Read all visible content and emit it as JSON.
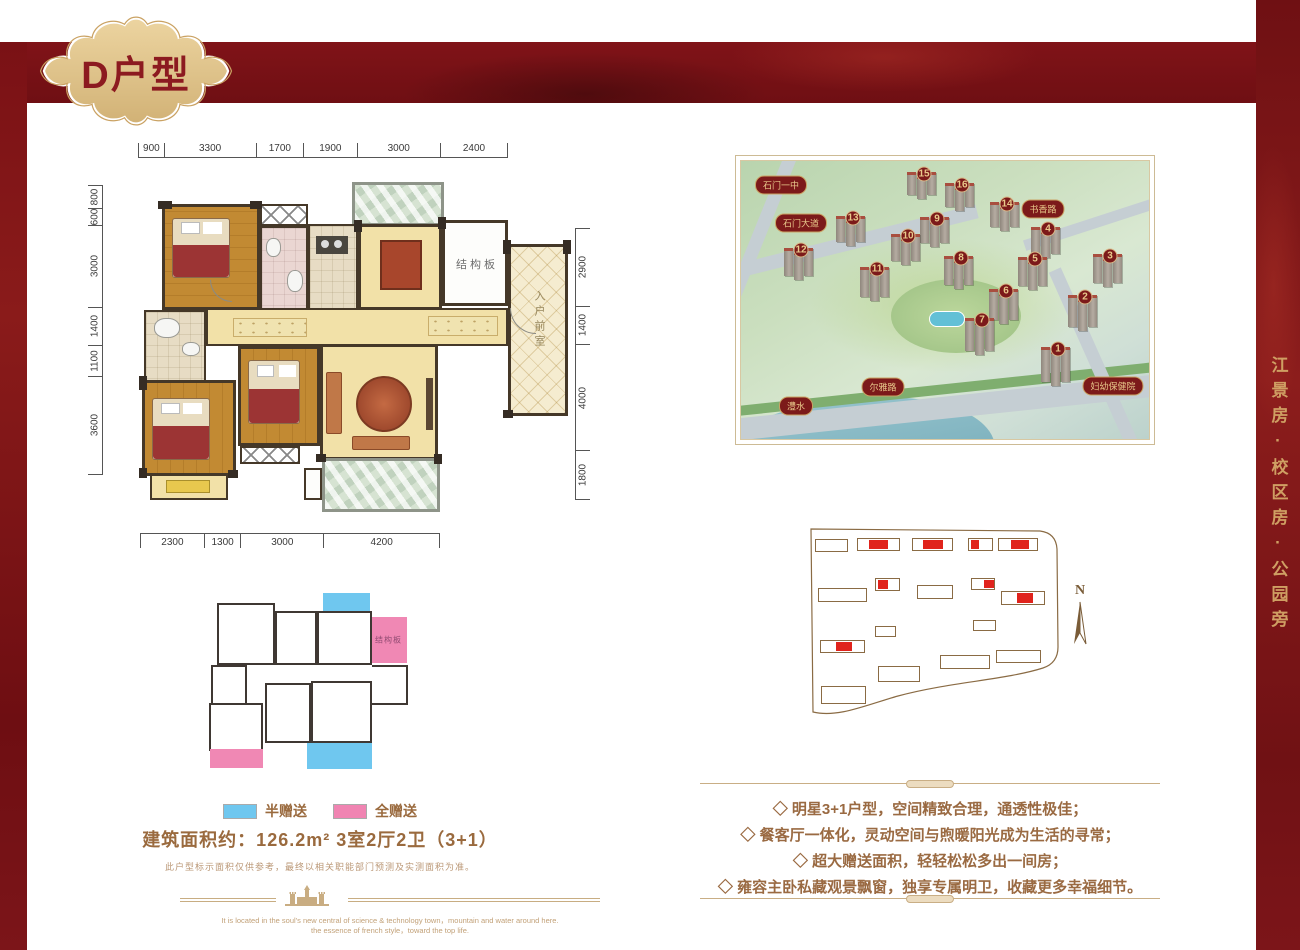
{
  "badge": {
    "title": "D户型"
  },
  "side_banner": {
    "text": "江景房·校区房·公园旁"
  },
  "colors": {
    "maroon": "#7a1216",
    "gold": "#caa263",
    "badge_gold": "#e2c48c",
    "text_brown": "#9a6a42",
    "legend_blue": "#6fc7ef",
    "legend_pink": "#f084b2",
    "highlight_red": "#e0231c"
  },
  "floorplan": {
    "dims_top": [
      "900",
      "3300",
      "1700",
      "1900",
      "3000",
      "2400"
    ],
    "dims_left": [
      "800",
      "600",
      "3000",
      "1400",
      "1100",
      "3600"
    ],
    "dims_right": [
      "2900",
      "1400",
      "4000",
      "1800"
    ],
    "dims_bottom": [
      "2300",
      "1300",
      "3000",
      "4200"
    ],
    "labels": {
      "structural_slab": "结构板",
      "entry_foyer": "入户前室"
    }
  },
  "mini_plan": {
    "structural_slab": "结构板"
  },
  "legend": {
    "half": {
      "label": "半赠送",
      "color": "#6fc7ef"
    },
    "full": {
      "label": "全赠送",
      "color": "#f084b2"
    }
  },
  "summary": {
    "area_line": "建筑面积约：126.2m²  3室2厅2卫（3+1）"
  },
  "disclaimer": "此户型标示面积仅供参考，最终以相关职能部门预测及实测面积为准。",
  "aerial": {
    "map_labels": [
      {
        "text": "石门一中",
        "x": 40,
        "y": 24
      },
      {
        "text": "石门大道",
        "x": 60,
        "y": 62
      },
      {
        "text": "书香路",
        "x": 302,
        "y": 48
      },
      {
        "text": "妇幼保健院",
        "x": 372,
        "y": 225
      },
      {
        "text": "尔雅路",
        "x": 142,
        "y": 226
      },
      {
        "text": "澧水",
        "x": 55,
        "y": 245
      }
    ],
    "buildings": [
      {
        "n": "15",
        "x": 183,
        "y": 13
      },
      {
        "n": "16",
        "x": 221,
        "y": 24
      },
      {
        "n": "14",
        "x": 266,
        "y": 43
      },
      {
        "n": "13",
        "x": 112,
        "y": 57
      },
      {
        "n": "9",
        "x": 196,
        "y": 58
      },
      {
        "n": "4",
        "x": 307,
        "y": 68
      },
      {
        "n": "10",
        "x": 167,
        "y": 75
      },
      {
        "n": "12",
        "x": 60,
        "y": 89
      },
      {
        "n": "3",
        "x": 369,
        "y": 95
      },
      {
        "n": "8",
        "x": 220,
        "y": 97
      },
      {
        "n": "5",
        "x": 294,
        "y": 98
      },
      {
        "n": "11",
        "x": 136,
        "y": 108
      },
      {
        "n": "6",
        "x": 265,
        "y": 130
      },
      {
        "n": "2",
        "x": 344,
        "y": 136
      },
      {
        "n": "7",
        "x": 241,
        "y": 159
      },
      {
        "n": "1",
        "x": 317,
        "y": 188
      }
    ]
  },
  "siteplan": {
    "north": "N",
    "buildings": [
      {
        "x": 15,
        "y": 14,
        "w": 33,
        "h": 13
      },
      {
        "x": 57,
        "y": 13,
        "w": 43,
        "h": 13,
        "red": {
          "x": 11,
          "w": 19
        }
      },
      {
        "x": 112,
        "y": 13,
        "w": 41,
        "h": 13,
        "red": {
          "x": 10,
          "w": 20
        }
      },
      {
        "x": 168,
        "y": 13,
        "w": 25,
        "h": 13,
        "red": {
          "x": 2,
          "w": 8
        }
      },
      {
        "x": 198,
        "y": 13,
        "w": 40,
        "h": 13,
        "red": {
          "x": 12,
          "w": 18
        }
      },
      {
        "x": 18,
        "y": 63,
        "w": 49,
        "h": 14
      },
      {
        "x": 75,
        "y": 53,
        "w": 25,
        "h": 13,
        "red": {
          "x": 2,
          "w": 10
        }
      },
      {
        "x": 117,
        "y": 60,
        "w": 36,
        "h": 14
      },
      {
        "x": 171,
        "y": 53,
        "w": 24,
        "h": 12,
        "red": {
          "x": 12,
          "w": 10
        }
      },
      {
        "x": 201,
        "y": 66,
        "w": 44,
        "h": 14,
        "red": {
          "x": 15,
          "w": 16
        }
      },
      {
        "x": 75,
        "y": 101,
        "w": 21,
        "h": 11
      },
      {
        "x": 173,
        "y": 95,
        "w": 23,
        "h": 11
      },
      {
        "x": 20,
        "y": 115,
        "w": 45,
        "h": 13,
        "red": {
          "x": 15,
          "w": 16
        }
      },
      {
        "x": 140,
        "y": 130,
        "w": 50,
        "h": 14
      },
      {
        "x": 196,
        "y": 125,
        "w": 45,
        "h": 13
      },
      {
        "x": 78,
        "y": 141,
        "w": 42,
        "h": 16
      },
      {
        "x": 21,
        "y": 161,
        "w": 45,
        "h": 18
      }
    ]
  },
  "features": {
    "items": [
      "◇ 明星3+1户型，空间精致合理，通透性极佳；",
      "◇ 餐客厅一体化，灵动空间与煦暖阳光成为生活的寻常；",
      "◇ 超大赠送面积，轻轻松松多出一间房；",
      "◇ 雍容主卧私藏观景飘窗，独享专属明卫，收藏更多幸福细节。"
    ]
  },
  "footer": {
    "en_line1": "It is located in the soul's new central of science & technology town，mountain and water around here.",
    "en_line2": "the essence of french style，toward the top life."
  }
}
